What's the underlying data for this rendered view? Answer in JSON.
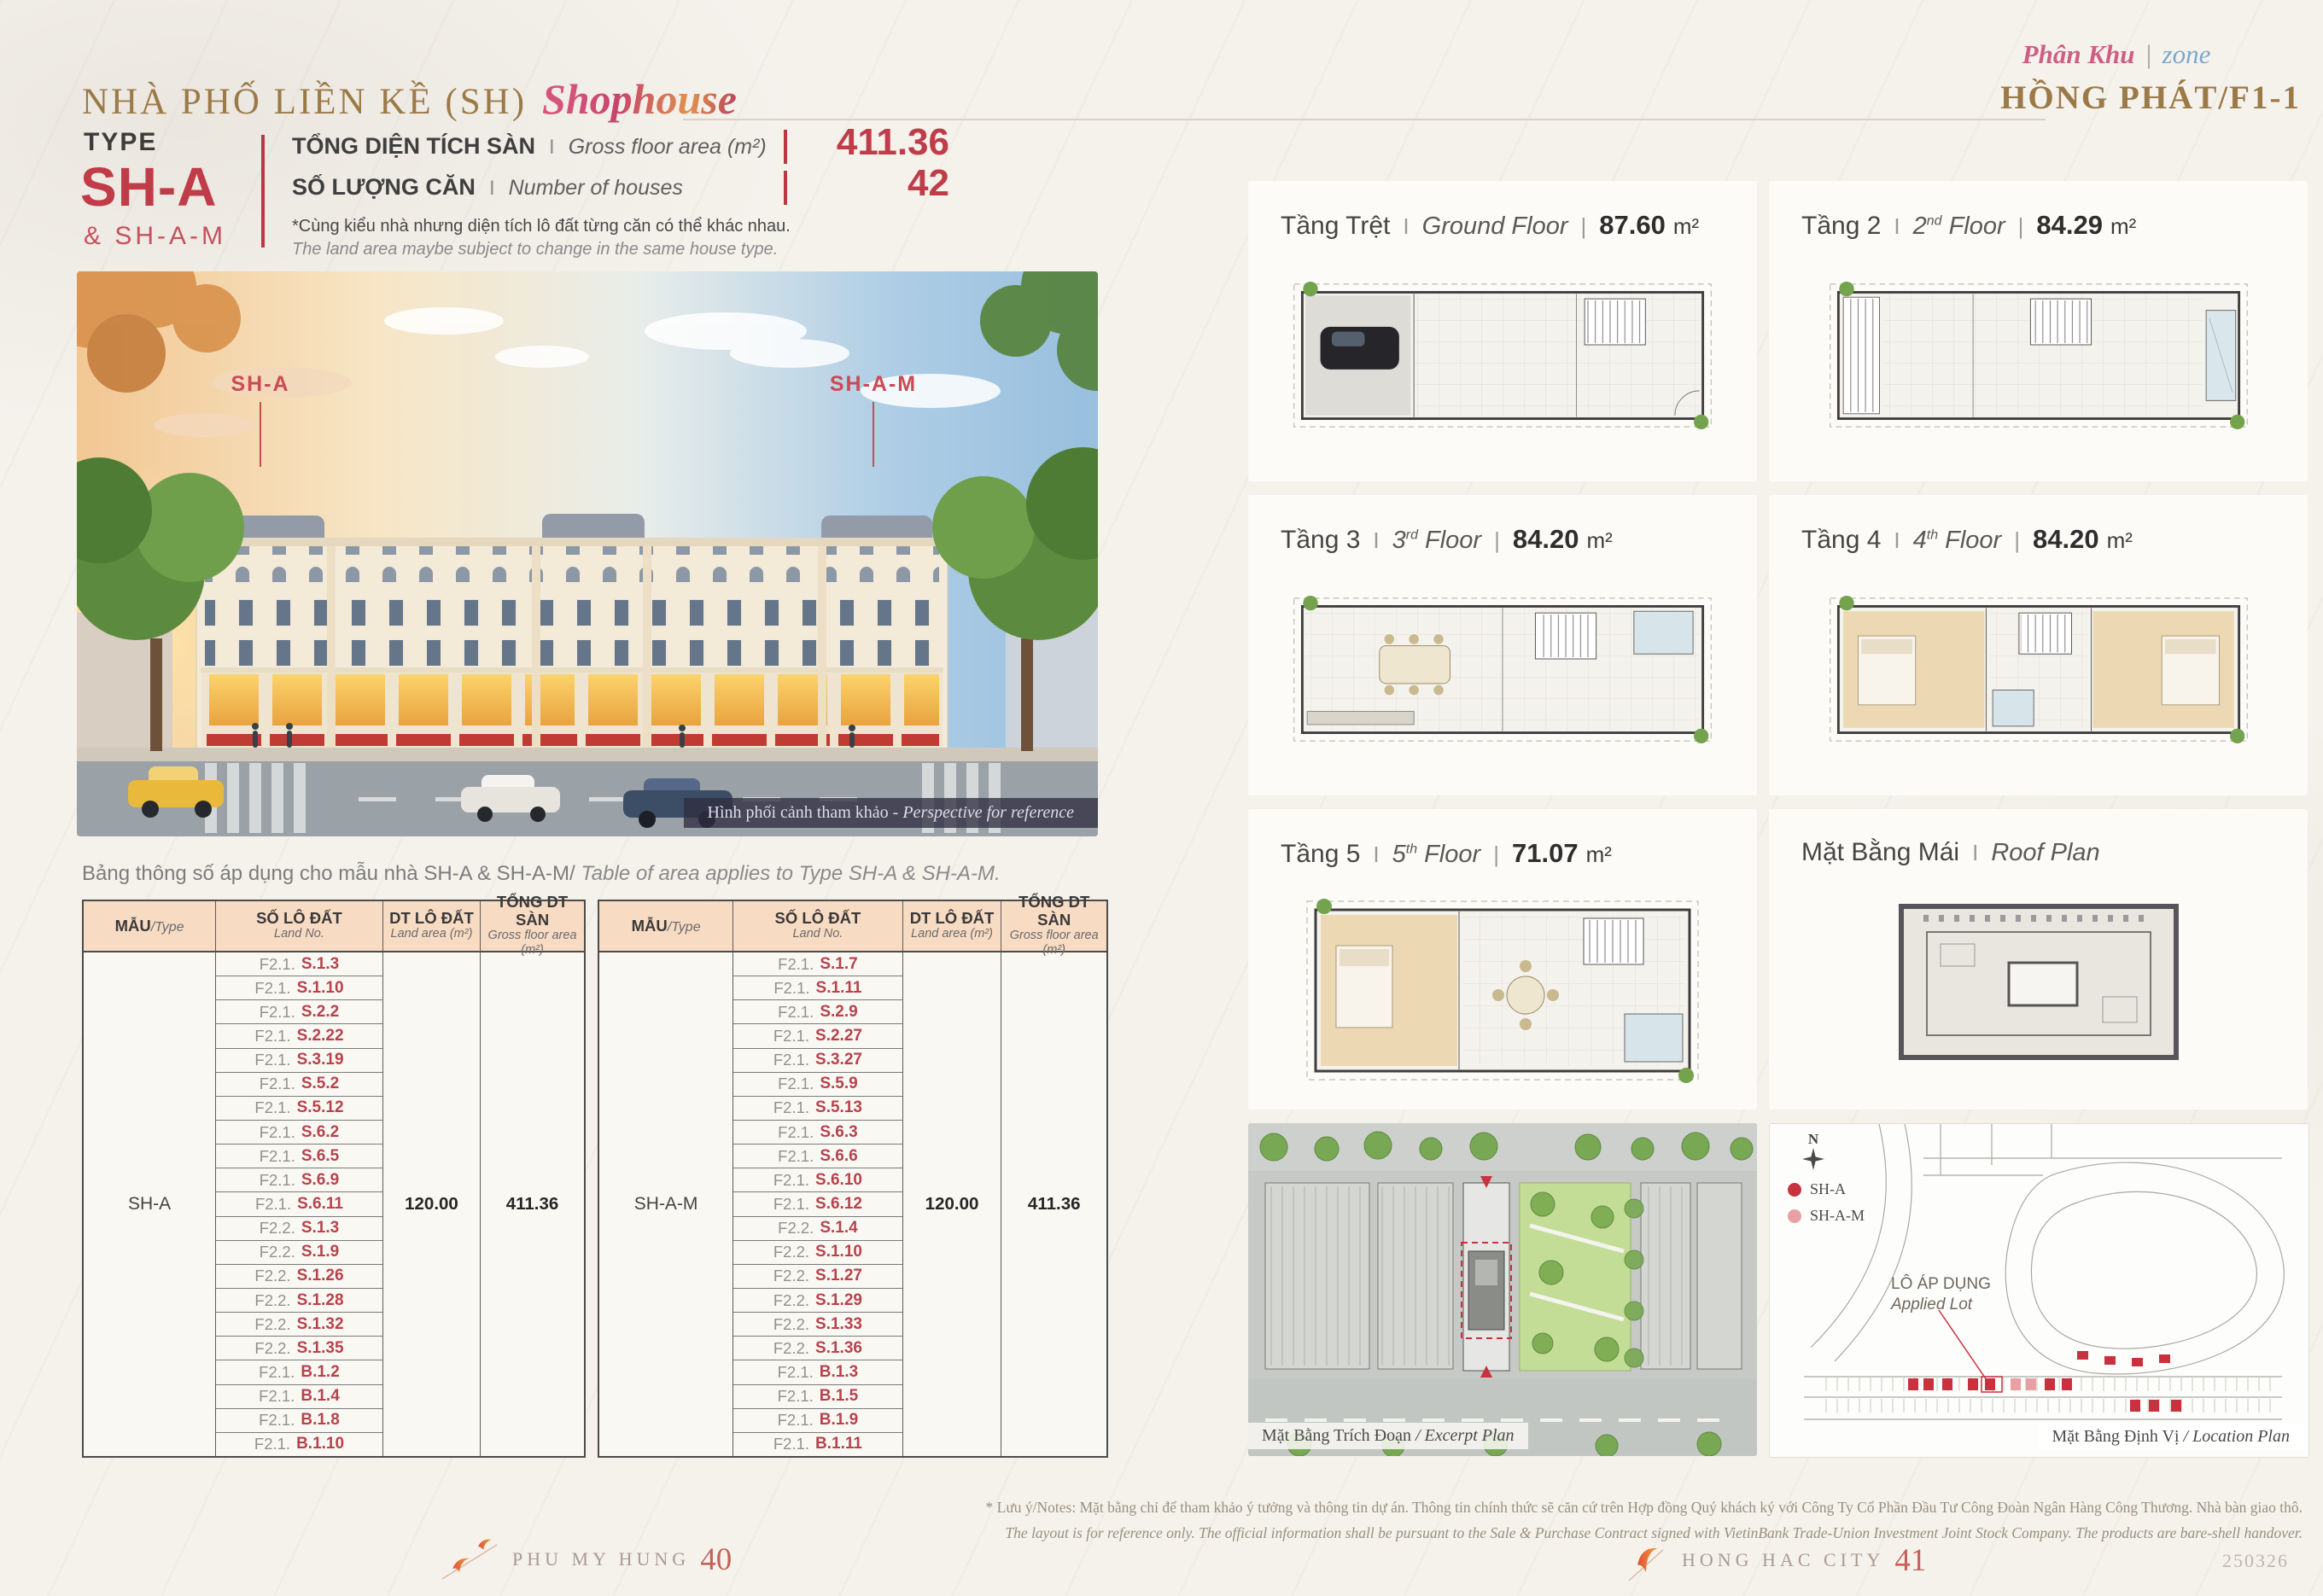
{
  "page": {
    "title_vi": "NHÀ PHỐ LIỀN KỀ (SH)",
    "title_script": "Shophouse",
    "zone_script_vi": "Phân Khu",
    "zone_script_divider": "|",
    "zone_script_en": "zone",
    "zone_name": "HỒNG PHÁT/F1-1"
  },
  "type_block": {
    "label": "TYPE",
    "code": "SH-A",
    "code_secondary": "& SH-A-M"
  },
  "stats": {
    "gfa_label_vi": "TỔNG DIỆN TÍCH SÀN",
    "sep": "I",
    "gfa_label_en": "Gross floor area (m²)",
    "gfa_value": "411.36",
    "houses_label_vi": "SỐ LƯỢNG CĂN",
    "houses_label_en": "Number of houses",
    "houses_value": "42",
    "note_vi": "*Cùng kiểu nhà nhưng diện tích lô đất từng căn có thể khác nhau.",
    "note_en": "The land area maybe subject to change in the same house type."
  },
  "rendering": {
    "label_left": "SH-A",
    "label_right": "SH-A-M",
    "caption_vi": "Hình phối cảnh tham khảo - ",
    "caption_en": "Perspective for reference"
  },
  "table_caption": {
    "vi": "Bảng thông số áp dụng cho mẫu nhà SH-A & SH-A-M/",
    "en": " Table of area applies to Type SH-A & SH-A-M."
  },
  "table_headers": {
    "type_vi": "MẪU",
    "type_en": "/Type",
    "lot_vi": "SỐ LÔ ĐẤT",
    "lot_en": "Land No.",
    "area_vi": "DT LÔ ĐẤT",
    "area_en": "Land area (m²)",
    "gfa_vi": "TỔNG DT SÀN",
    "gfa_en": "Gross floor area (m²)"
  },
  "tables": [
    {
      "type": "SH-A",
      "land_area": "120.00",
      "gfa": "411.36",
      "rows": [
        {
          "prefix": "F2.1.",
          "code": "S.1.3"
        },
        {
          "prefix": "F2.1.",
          "code": "S.1.10"
        },
        {
          "prefix": "F2.1.",
          "code": "S.2.2"
        },
        {
          "prefix": "F2.1.",
          "code": "S.2.22"
        },
        {
          "prefix": "F2.1.",
          "code": "S.3.19"
        },
        {
          "prefix": "F2.1.",
          "code": "S.5.2"
        },
        {
          "prefix": "F2.1.",
          "code": "S.5.12"
        },
        {
          "prefix": "F2.1.",
          "code": "S.6.2"
        },
        {
          "prefix": "F2.1.",
          "code": "S.6.5"
        },
        {
          "prefix": "F2.1.",
          "code": "S.6.9"
        },
        {
          "prefix": "F2.1.",
          "code": "S.6.11"
        },
        {
          "prefix": "F2.2.",
          "code": "S.1.3"
        },
        {
          "prefix": "F2.2.",
          "code": "S.1.9"
        },
        {
          "prefix": "F2.2.",
          "code": "S.1.26"
        },
        {
          "prefix": "F2.2.",
          "code": "S.1.28"
        },
        {
          "prefix": "F2.2.",
          "code": "S.1.32"
        },
        {
          "prefix": "F2.2.",
          "code": "S.1.35"
        },
        {
          "prefix": "F2.1.",
          "code": "B.1.2"
        },
        {
          "prefix": "F2.1.",
          "code": "B.1.4"
        },
        {
          "prefix": "F2.1.",
          "code": "B.1.8"
        },
        {
          "prefix": "F2.1.",
          "code": "B.1.10"
        }
      ]
    },
    {
      "type": "SH-A-M",
      "land_area": "120.00",
      "gfa": "411.36",
      "rows": [
        {
          "prefix": "F2.1.",
          "code": "S.1.7"
        },
        {
          "prefix": "F2.1.",
          "code": "S.1.11"
        },
        {
          "prefix": "F2.1.",
          "code": "S.2.9"
        },
        {
          "prefix": "F2.1.",
          "code": "S.2.27"
        },
        {
          "prefix": "F2.1.",
          "code": "S.3.27"
        },
        {
          "prefix": "F2.1.",
          "code": "S.5.9"
        },
        {
          "prefix": "F2.1.",
          "code": "S.5.13"
        },
        {
          "prefix": "F2.1.",
          "code": "S.6.3"
        },
        {
          "prefix": "F2.1.",
          "code": "S.6.6"
        },
        {
          "prefix": "F2.1.",
          "code": "S.6.10"
        },
        {
          "prefix": "F2.1.",
          "code": "S.6.12"
        },
        {
          "prefix": "F2.2.",
          "code": "S.1.4"
        },
        {
          "prefix": "F2.2.",
          "code": "S.1.10"
        },
        {
          "prefix": "F2.2.",
          "code": "S.1.27"
        },
        {
          "prefix": "F2.2.",
          "code": "S.1.29"
        },
        {
          "prefix": "F2.2.",
          "code": "S.1.33"
        },
        {
          "prefix": "F2.2.",
          "code": "S.1.36"
        },
        {
          "prefix": "F2.1.",
          "code": "B.1.3"
        },
        {
          "prefix": "F2.1.",
          "code": "B.1.5"
        },
        {
          "prefix": "F2.1.",
          "code": "B.1.9"
        },
        {
          "prefix": "F2.1.",
          "code": "B.1.11"
        }
      ]
    }
  ],
  "floors": [
    {
      "vi": "Tầng Trệt",
      "sep1": "I",
      "en_pre": "Ground Floor",
      "en_sup": "",
      "en_post": "",
      "sep2": "|",
      "area": "87.60",
      "unit": "m²"
    },
    {
      "vi": "Tầng 2",
      "sep1": "I",
      "en_pre": "2",
      "en_sup": "nd",
      "en_post": " Floor",
      "sep2": "|",
      "area": "84.29",
      "unit": "m²"
    },
    {
      "vi": "Tầng 3",
      "sep1": "I",
      "en_pre": "3",
      "en_sup": "rd",
      "en_post": " Floor",
      "sep2": "|",
      "area": "84.20",
      "unit": "m²"
    },
    {
      "vi": "Tầng 4",
      "sep1": "I",
      "en_pre": "4",
      "en_sup": "th",
      "en_post": " Floor",
      "sep2": "|",
      "area": "84.20",
      "unit": "m²"
    },
    {
      "vi": "Tầng 5",
      "sep1": "I",
      "en_pre": "5",
      "en_sup": "th",
      "en_post": " Floor",
      "sep2": "|",
      "area": "71.07",
      "unit": "m²"
    },
    {
      "vi": "Mặt Bằng Mái",
      "sep1": "I",
      "en_pre": "Roof Plan",
      "en_sup": "",
      "en_post": "",
      "sep2": "",
      "area": "",
      "unit": ""
    }
  ],
  "maps": {
    "excerpt_caption_vi": "Mặt Bằng Trích Đoạn",
    "excerpt_caption_en": " / Excerpt Plan",
    "location_caption_vi": "Mặt Bằng Định Vị",
    "location_caption_en": " / Location Plan",
    "legend": [
      {
        "label": "SH-A",
        "color": "#c8313e"
      },
      {
        "label": "SH-A-M",
        "color": "#e8a0a4"
      }
    ],
    "applied_lot_vi": "LÔ ÁP DỤNG",
    "applied_lot_en": "Applied Lot",
    "compass": "N"
  },
  "footer": {
    "notes_vi": "* Lưu ý/Notes: Mặt bằng chỉ để tham khảo ý tưởng và thông tin dự án. Thông tin chính thức sẽ căn cứ trên Hợp đồng Quý khách ký với Công Ty Cổ Phần Đầu Tư Công Đoàn Ngân Hàng Công Thương. Nhà bàn giao thô.",
    "notes_en": "The layout is for reference only. The official information shall be pursuant to the Sale & Purchase Contract signed with VietinBank Trade-Union Investment Joint Stock Company. The products are bare-shell handover.",
    "brand_left": "PHU MY HUNG",
    "page_left": "40",
    "brand_right": "HONG HAC CITY",
    "page_right": "41",
    "doc_code": "250326"
  },
  "colors": {
    "accent_red": "#bf3c48",
    "gold": "#9c7a48",
    "table_header_bg": "#f8dbc3",
    "script_pink": "#cf5d84",
    "script_blue": "#7aa8cc"
  }
}
